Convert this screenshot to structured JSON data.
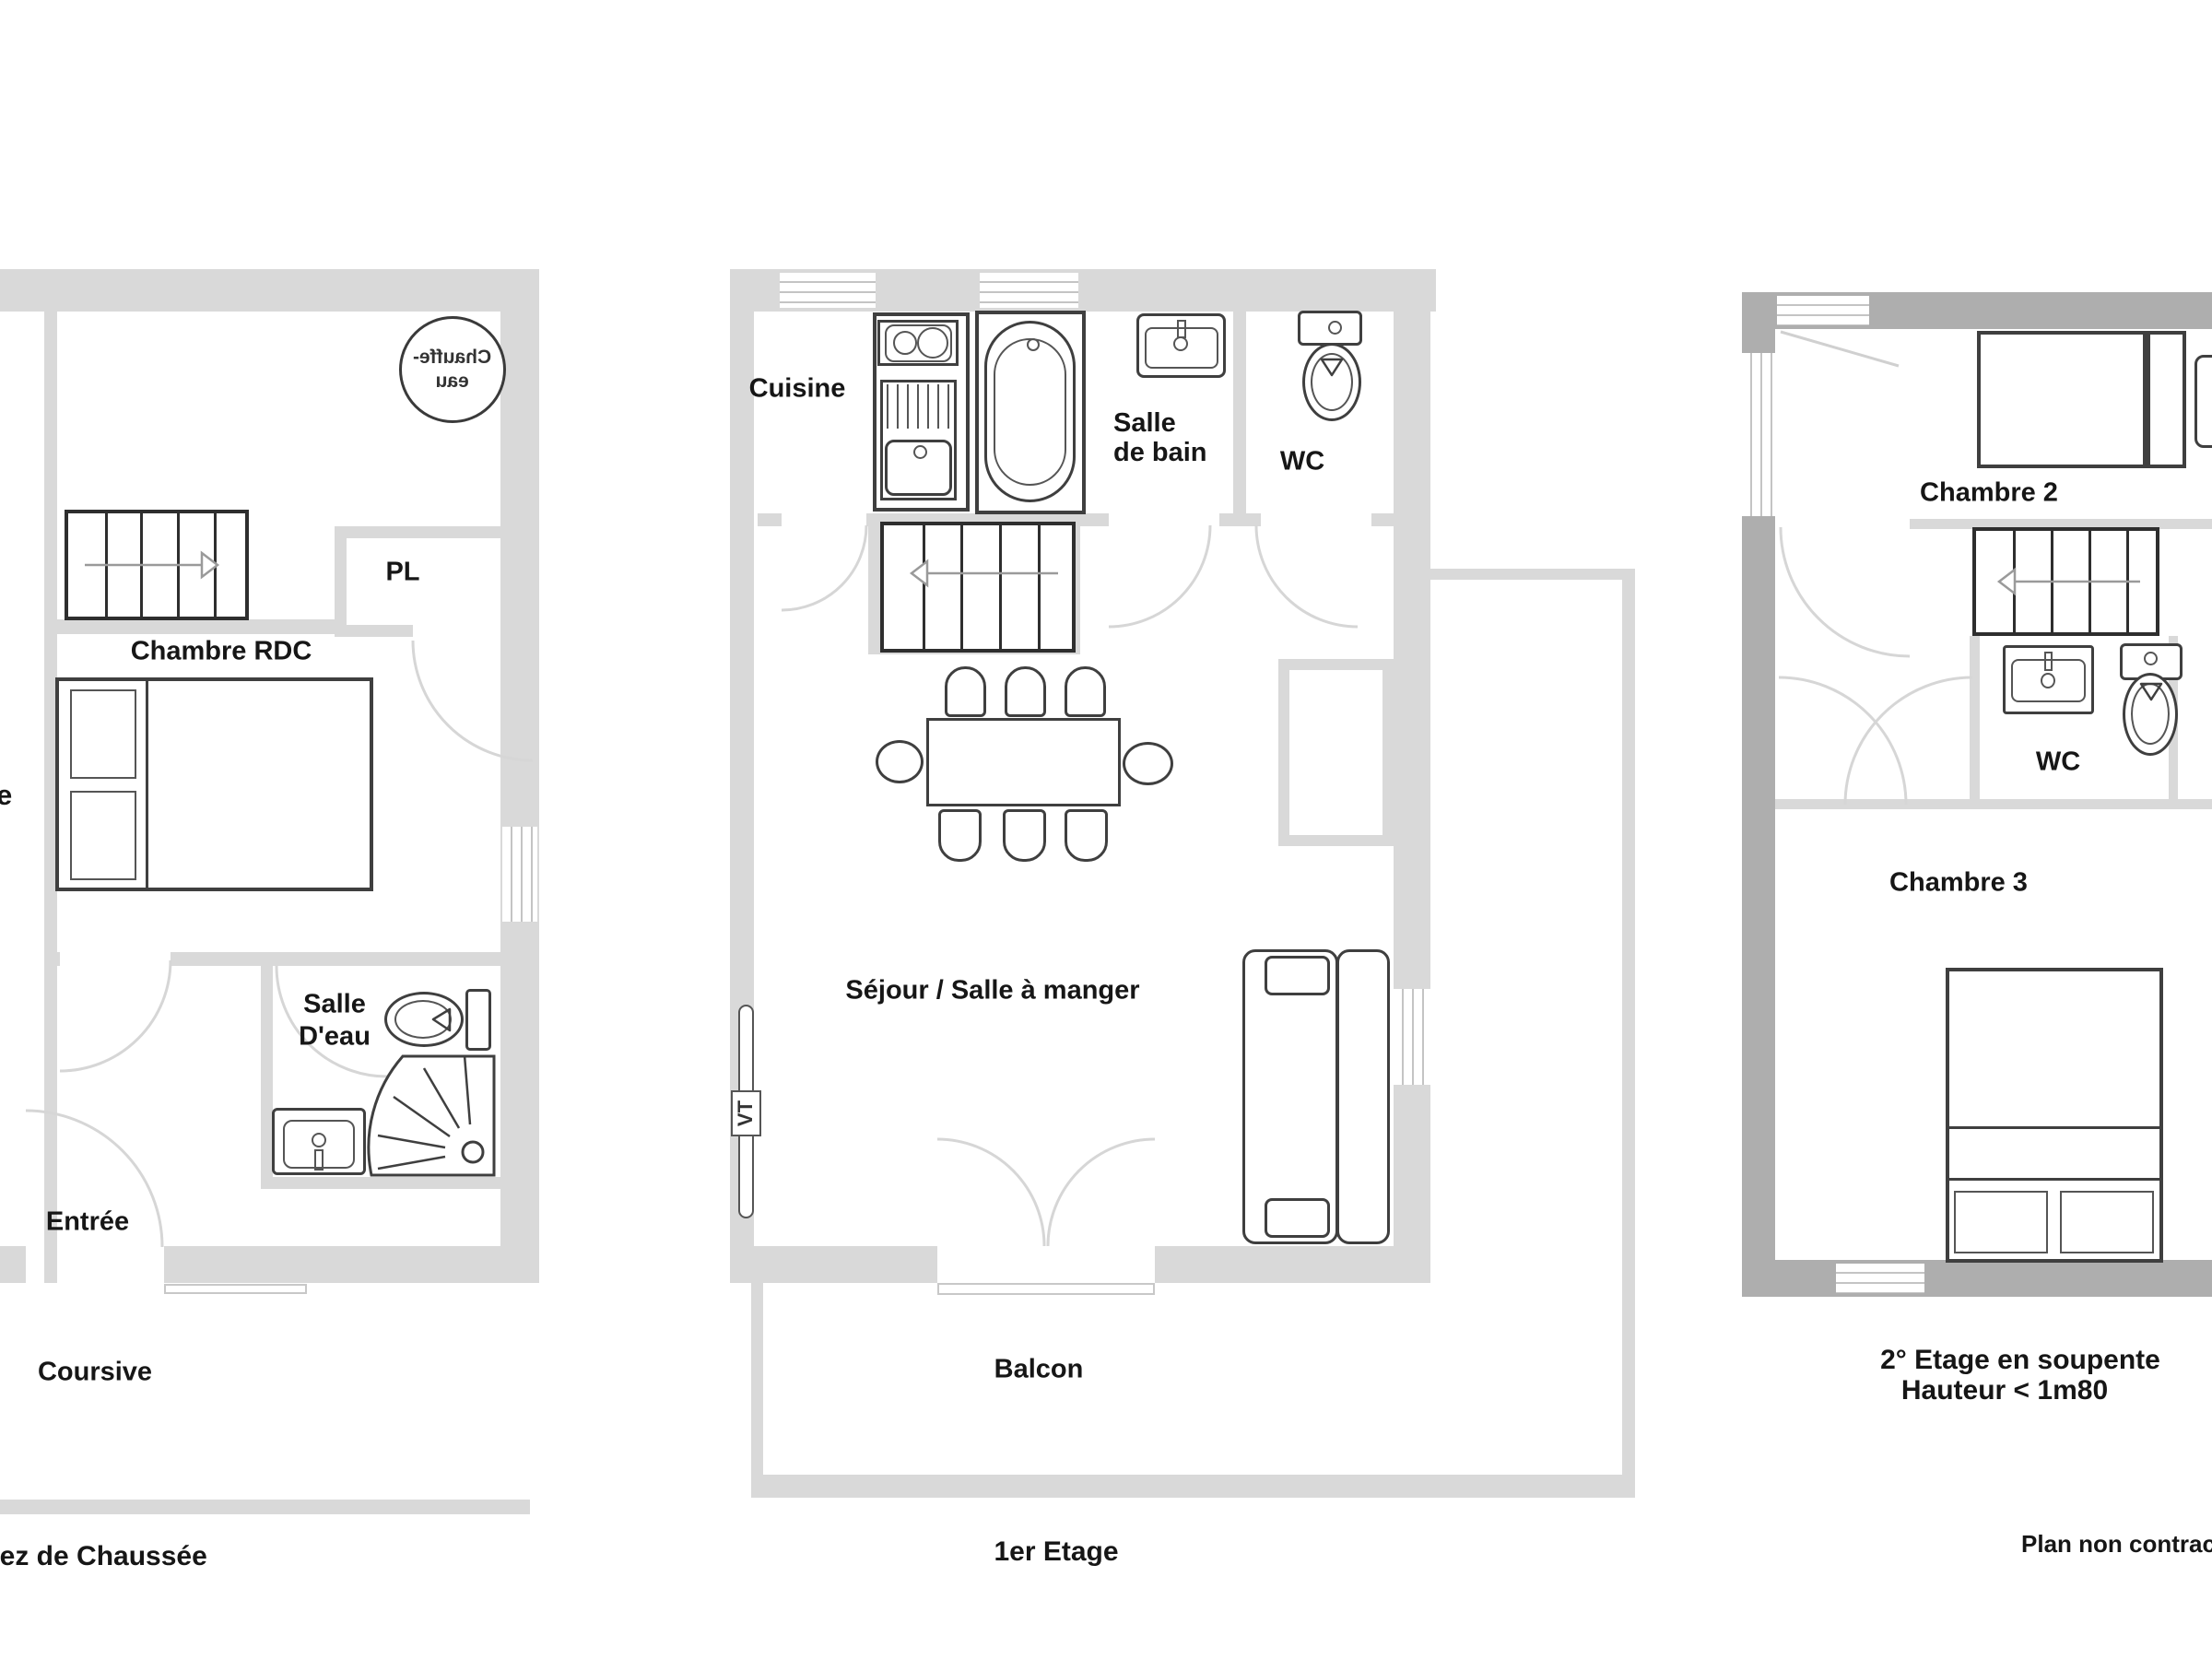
{
  "colors": {
    "wall_light": "#d9d9d9",
    "wall_dark": "#aeaeae",
    "line_dark": "#3f3f3f",
    "door_arc": "#d6d6d6"
  },
  "rdc": {
    "floor_label": "Rez de Chaussée",
    "chauffe_eau_line1": "Chauffe-",
    "chauffe_eau_line2": "eau",
    "pl": "PL",
    "chambre": "Chambre RDC",
    "salle_eau_line1": "Salle",
    "salle_eau_line2": "D'eau",
    "entree": "Entrée",
    "coursive": "Coursive",
    "edge_fragment": "e"
  },
  "etage1": {
    "floor_label": "1er Etage",
    "cuisine": "Cuisine",
    "salle_bain_line1": "Salle",
    "salle_bain_line2": "de bain",
    "wc": "WC",
    "sejour": "Séjour / Salle à manger",
    "balcon": "Balcon",
    "radiator": "VT"
  },
  "etage2": {
    "floor_label_line1": "2° Etage en soupente",
    "floor_label_line2": "Hauteur < 1m80",
    "chambre2": "Chambre 2",
    "wc": "WC",
    "chambre3": "Chambre 3"
  },
  "footnote": "Plan non contractuel"
}
